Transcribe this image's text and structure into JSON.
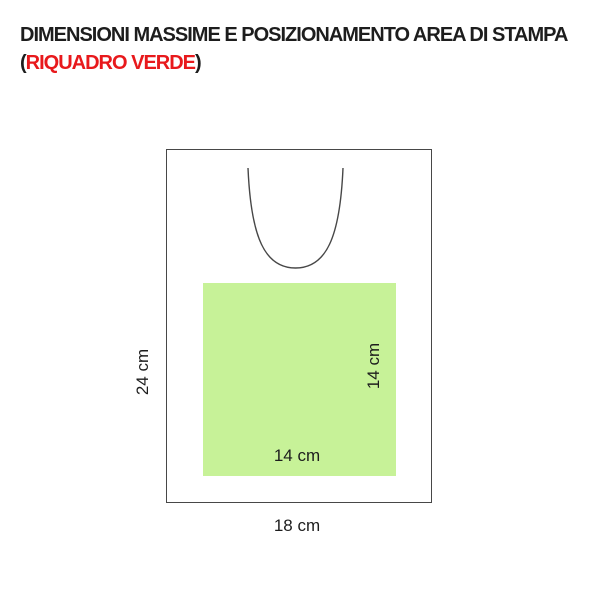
{
  "title": {
    "line1": "DIMENSIONI MASSIME E POSIZIONAMENTO AREA DI STAMPA",
    "paren_open": "(",
    "highlight": "RIQUADRO VERDE",
    "paren_close": ")",
    "text_color": "#1d1d1d",
    "highlight_color": "#e8191c"
  },
  "diagram": {
    "outline_color": "#474747",
    "product": {
      "height_label": "24 cm",
      "width_label": "18 cm"
    },
    "print_area": {
      "fill_color": "#c7f298",
      "height_label": "14 cm",
      "width_label": "14 cm"
    }
  }
}
